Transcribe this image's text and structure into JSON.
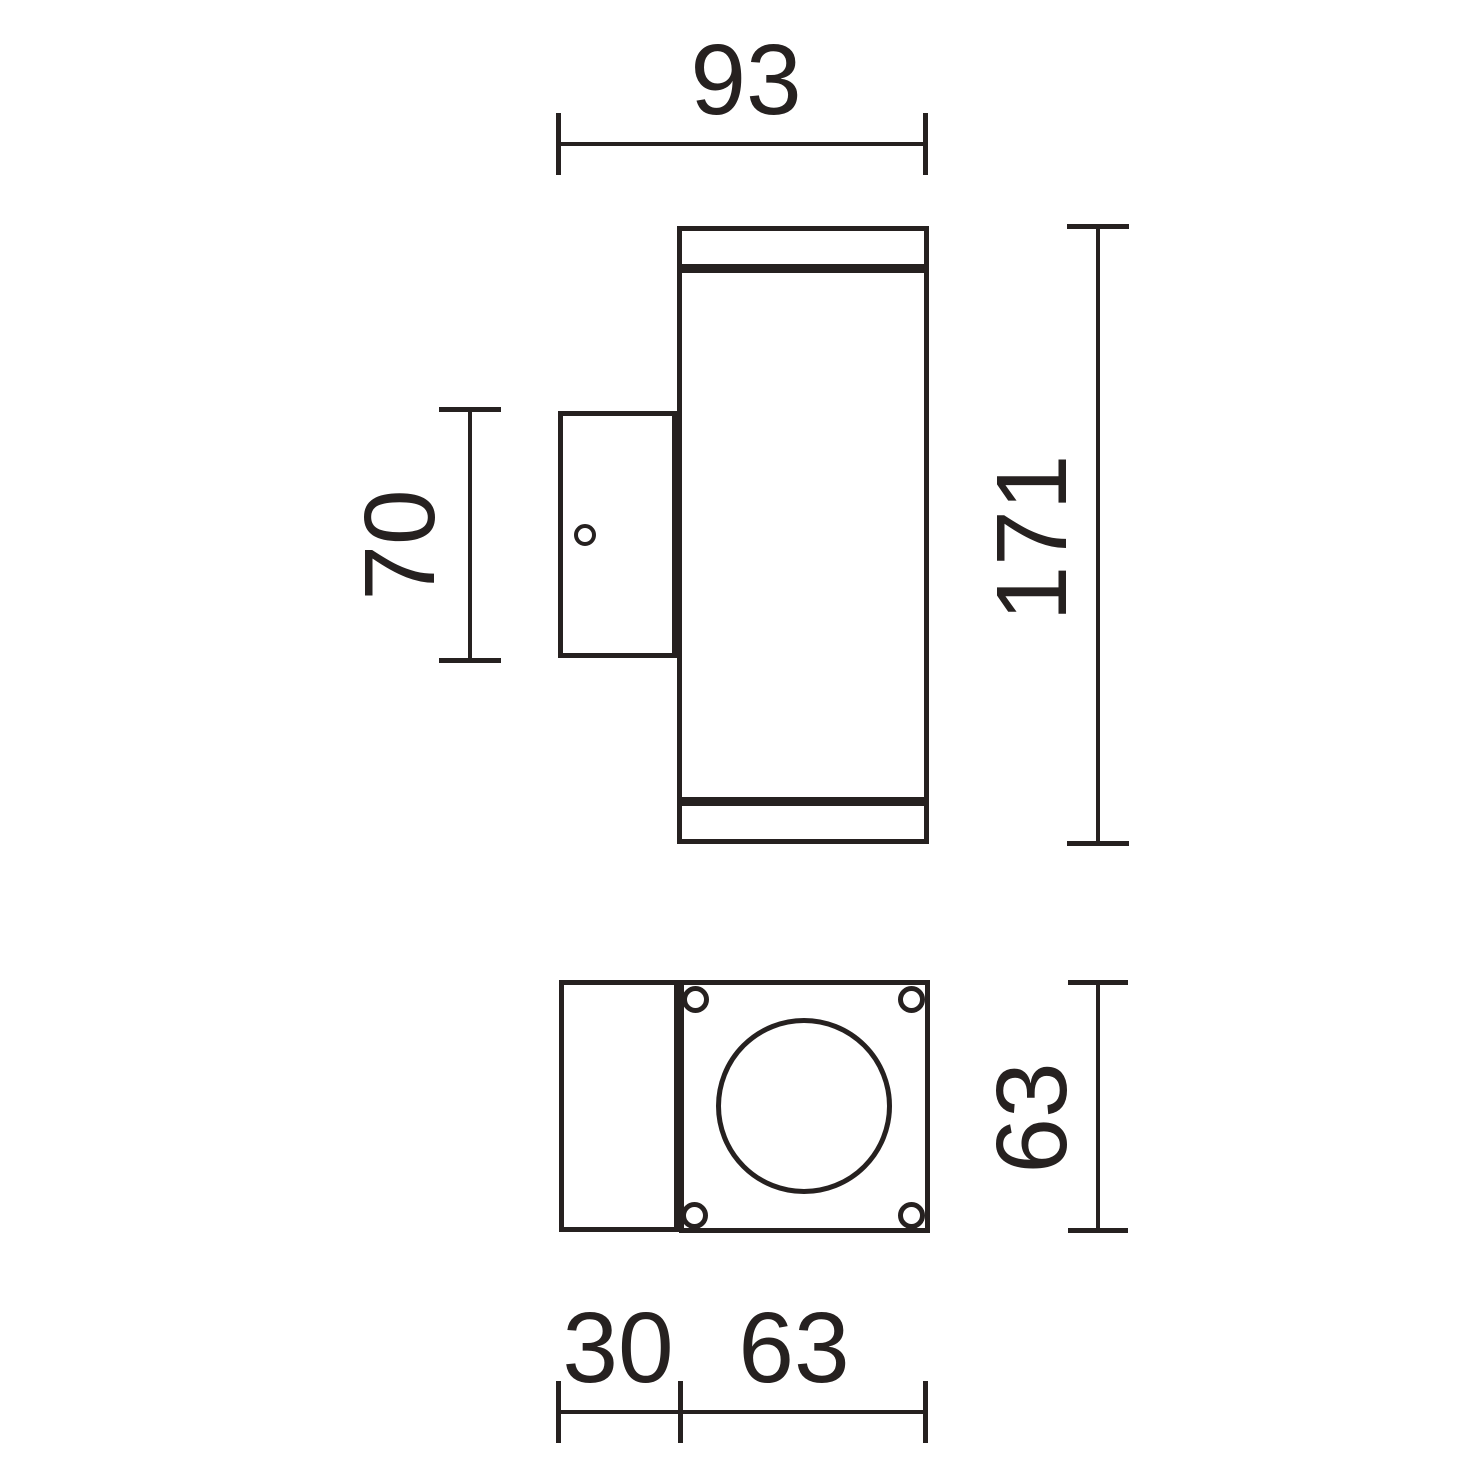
{
  "colors": {
    "ink": "#262120",
    "background": "#ffffff"
  },
  "drawing": {
    "kind": "technical-dimension-drawing",
    "subject": "cylindrical wall luminaire with mounting bracket, side view and bottom view",
    "units_shown": false,
    "dimensions": {
      "overall_width": "93",
      "overall_height": "171",
      "bracket_height": "70",
      "base_height": "63",
      "bracket_depth": "30",
      "base_width": "63"
    }
  }
}
